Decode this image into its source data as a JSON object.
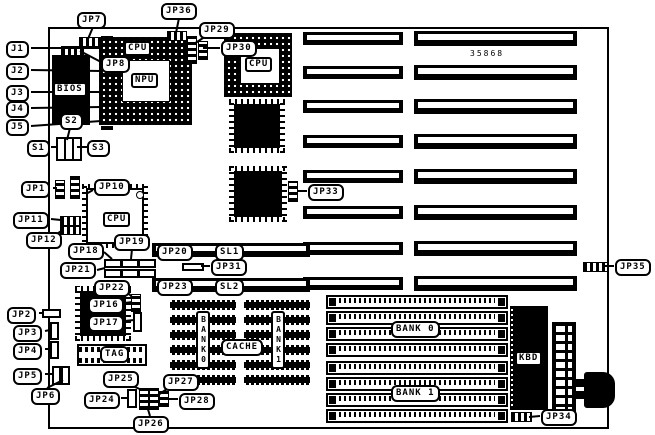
{
  "diagram": {
    "part_number": "35868",
    "connectors": {
      "j1": "J1",
      "j2": "J2",
      "j3": "J3",
      "j4": "J4",
      "j5": "J5"
    },
    "switches": {
      "s1": "S1",
      "s2": "S2",
      "s3": "S3"
    },
    "jumpers": {
      "jp1": "JP1",
      "jp2": "JP2",
      "jp3": "JP3",
      "jp4": "JP4",
      "jp5": "JP5",
      "jp6": "JP6",
      "jp7": "JP7",
      "jp8": "JP8",
      "jp10": "JP10",
      "jp11": "JP11",
      "jp12": "JP12",
      "jp16": "JP16",
      "jp17": "JP17",
      "jp18": "JP18",
      "jp19": "JP19",
      "jp20": "JP20",
      "jp21": "JP21",
      "jp22": "JP22",
      "jp23": "JP23",
      "jp24": "JP24",
      "jp25": "JP25",
      "jp26": "JP26",
      "jp27": "JP27",
      "jp28": "JP28",
      "jp29": "JP29",
      "jp30": "JP30",
      "jp31": "JP31",
      "jp33": "JP33",
      "jp34": "JP34",
      "jp35": "JP35",
      "jp36": "JP36"
    },
    "slots": {
      "sl1": "SL1",
      "sl2": "SL2"
    },
    "chips": {
      "bios": "BIOS",
      "cpu_socket_label": "CPU",
      "npu": "NPU",
      "cpu_socket2_label": "CPU",
      "cpu_qfp_label": "CPU",
      "kbd": "KBD",
      "tag": "TAG"
    },
    "memory": {
      "cache": "CACHE",
      "cache_bank0": "BANK0",
      "cache_bank1": "BANK1",
      "simm_bank0": "BANK 0",
      "simm_bank1": "BANK 1"
    }
  }
}
